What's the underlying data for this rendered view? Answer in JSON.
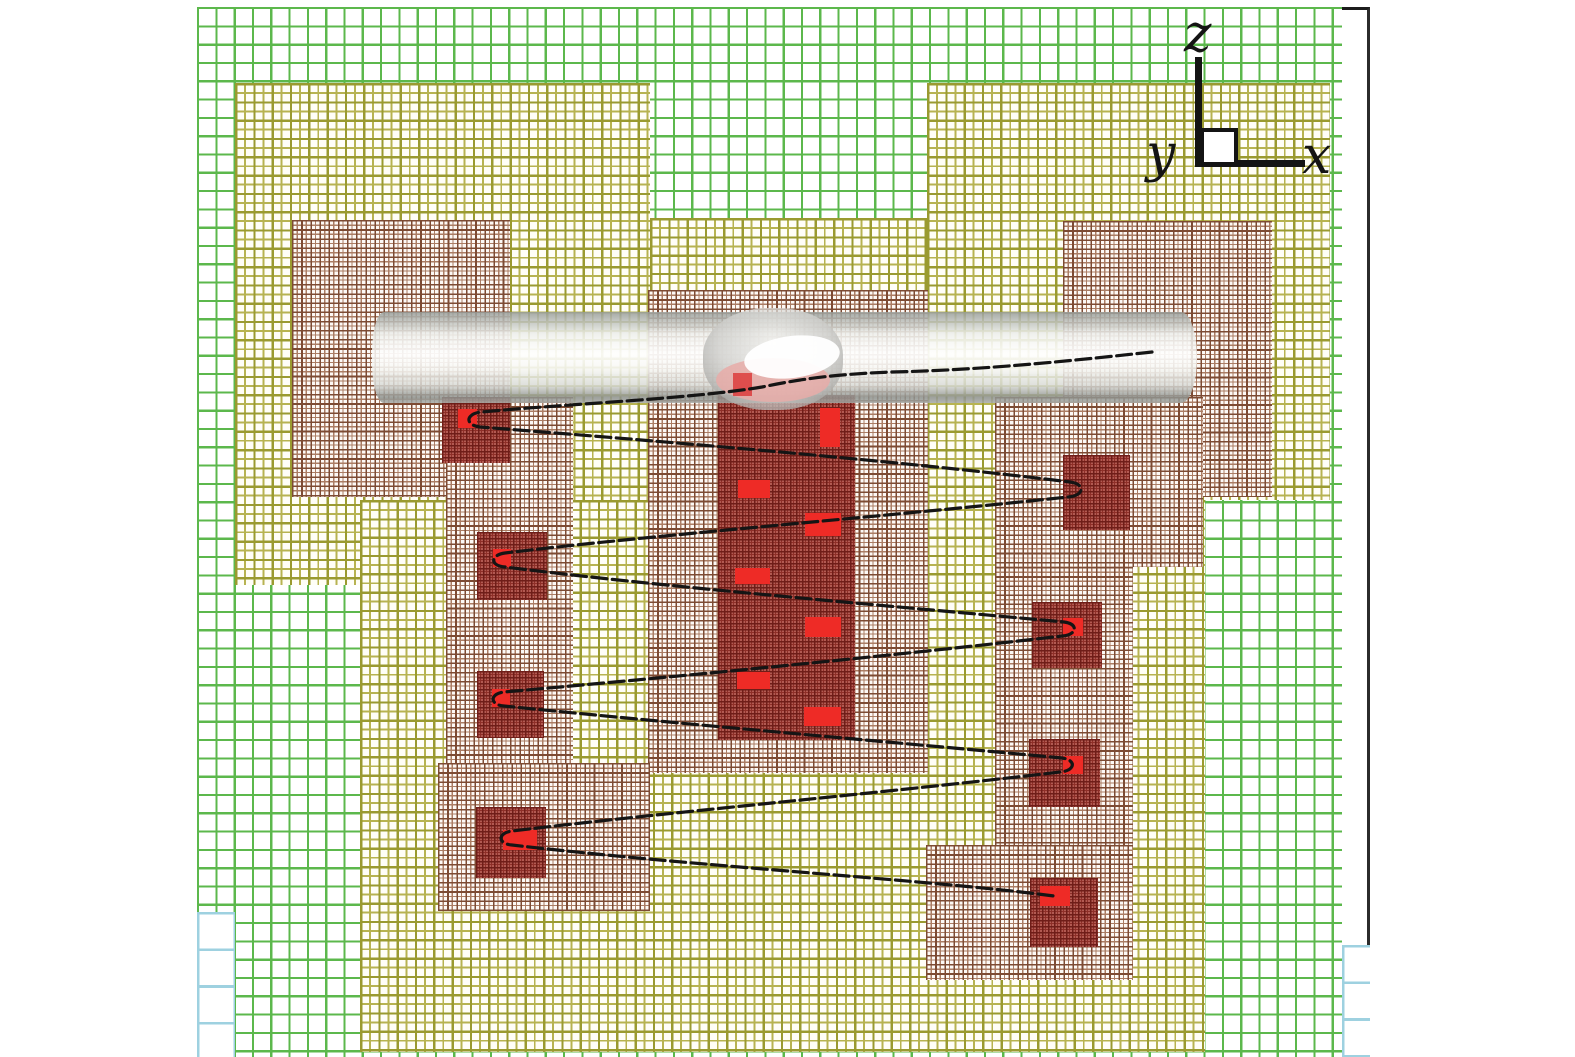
{
  "figure": {
    "description": "Adaptive mesh refinement (AMR) grid hierarchy, side view (x-z plane), with embedded cylindrical rod, blast bubble and a gyrating particle trajectory",
    "axis_labels": {
      "x": "x",
      "y": "y",
      "z": "z"
    }
  },
  "palette": {
    "background": "#ffffff",
    "plot_border": "#2b2b2b",
    "level0_blue": "#9ed1e0",
    "level1_green": "#5cb84c",
    "level2_olive": "#b3af4a",
    "level2_olive_major": "#9a9a30",
    "level3_brown": "#a5765c",
    "level3_brown_major": "#7d4b33",
    "level4_base": "#b25a52",
    "level4_line": "#8e2f28",
    "level4_major": "#6f1d18",
    "level5_red": "#ee2b26",
    "trajectory_black": "#151515",
    "rod_gray": "#8e928e",
    "bubble_gray": "#c9c9c6",
    "bubble_pink": "#e8aca8"
  },
  "mesh": {
    "levels": [
      {
        "name": "level-1-green",
        "cell": 18.3,
        "line_w": 2.2,
        "line_color": "#5cb84c",
        "bg": "#ffffff",
        "rects": [
          [
            197,
            7,
            1145,
            1050
          ]
        ]
      },
      {
        "name": "level-0-blue",
        "cell": 36.6,
        "line_w": 2.6,
        "line_color": "#9ed1e0",
        "bg": "#ffffff",
        "rects": [
          [
            197,
            912,
            38,
            145
          ],
          [
            1342,
            945,
            28,
            112
          ]
        ]
      },
      {
        "name": "level-2-olive",
        "cell": 9.15,
        "line_w": 1.9,
        "line_color": "#b7b351",
        "major_color": "#9a9a30",
        "bg": "#fffef7",
        "rects": [
          [
            235,
            83,
            415,
            502
          ],
          [
            927,
            83,
            403,
            417
          ],
          [
            650,
            218,
            277,
            282
          ],
          [
            360,
            500,
            845,
            552
          ]
        ]
      },
      {
        "name": "level-3-brown",
        "cell": 4.58,
        "line_w": 1.2,
        "line_color": "#ab7d64",
        "major_color": "#7d4b33",
        "bg": "#fdf9f5",
        "rects": [
          [
            292,
            220,
            218,
            277
          ],
          [
            648,
            290,
            280,
            483
          ],
          [
            1063,
            221,
            209,
            276
          ],
          [
            995,
            397,
            208,
            170
          ],
          [
            995,
            567,
            138,
            413
          ],
          [
            926,
            845,
            207,
            135
          ],
          [
            446,
            397,
            127,
            366
          ],
          [
            438,
            763,
            212,
            148
          ]
        ]
      },
      {
        "name": "level-4-darkred",
        "cell": 3.0,
        "line_w": 1.0,
        "line_color": "#8e2f28",
        "major_color": "#6f1d18",
        "bg": "#b25a52",
        "rects": [
          [
            442,
            397,
            68,
            66
          ],
          [
            477,
            532,
            70,
            68
          ],
          [
            477,
            671,
            67,
            67
          ],
          [
            476,
            807,
            70,
            71
          ],
          [
            718,
            395,
            137,
            345
          ],
          [
            1063,
            455,
            67,
            75
          ],
          [
            1032,
            602,
            70,
            66
          ],
          [
            1029,
            739,
            71,
            68
          ],
          [
            1030,
            878,
            68,
            69
          ]
        ]
      },
      {
        "name": "level-5-red",
        "fill": "#ee2b26",
        "rects": [
          [
            458,
            409,
            19,
            19
          ],
          [
            820,
            408,
            20,
            39
          ],
          [
            738,
            480,
            32,
            18
          ],
          [
            805,
            513,
            36,
            23
          ],
          [
            493,
            549,
            18,
            18
          ],
          [
            735,
            568,
            35,
            16
          ],
          [
            805,
            617,
            36,
            20
          ],
          [
            1063,
            618,
            20,
            18
          ],
          [
            737,
            672,
            33,
            17
          ],
          [
            804,
            707,
            37,
            19
          ],
          [
            492,
            689,
            18,
            18
          ],
          [
            1063,
            756,
            20,
            18
          ],
          [
            503,
            830,
            34,
            20
          ],
          [
            1040,
            886,
            30,
            20
          ]
        ]
      }
    ]
  },
  "objects": {
    "rod": {
      "x": 372,
      "y": 312,
      "w": 825,
      "h": 91
    },
    "bubble": {
      "cx": 773,
      "cy": 359,
      "rx": 70,
      "ry": 51
    },
    "bubble_patch": [
      733,
      373,
      19,
      23
    ]
  },
  "trajectory": {
    "color": "#151515",
    "stroke_width": 3.2,
    "dash": "15 5.5",
    "path": "M1152,352 C1060,362 980,370 892,372 C840,374 805,378 762,387 C690,399 565,404 482,412 c-16,1 -18,13 -2,15 C620,438 884,459 1070,482 c16,2 14,14 -2,15 C880,517 644,536 505,553 c-15,2 -15,13 0,14 C664,587 902,607 1064,622 c15,2 13,13 -2,14 C882,657 652,679 504,692 c-15,2 -14,13 0,14 C692,725 902,743 1062,758 c15,2 13,13 -2,14 C882,793 662,813 512,831 c-15,2 -14,13 0,14 C702,867 932,880 1054,896"
  }
}
